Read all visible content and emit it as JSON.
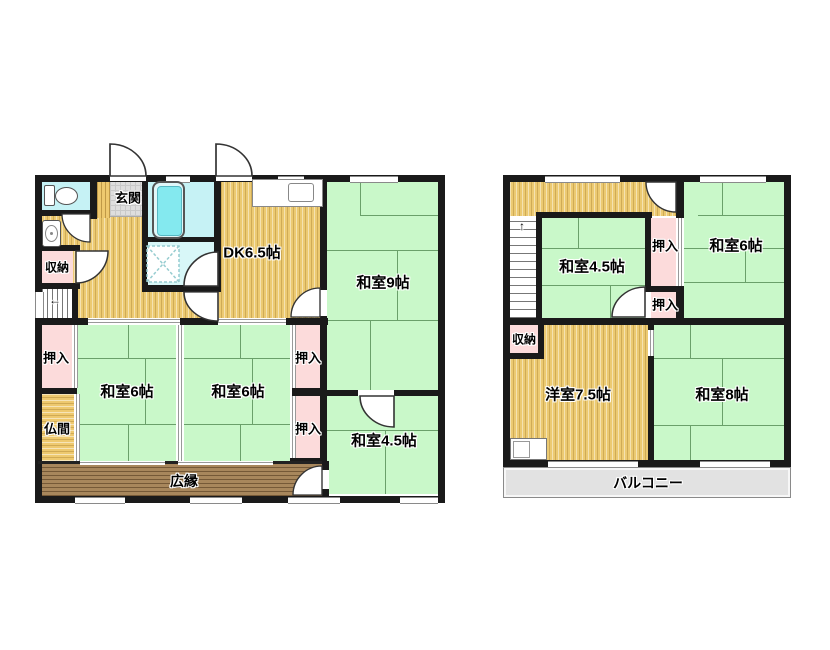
{
  "floor1": {
    "rooms": {
      "genkan": "玄関",
      "shuno": "収納",
      "dk": "DK6.5帖",
      "washitsu9": "和室9帖",
      "oshiire_left": "押入",
      "washitsu6_left": "和室6帖",
      "washitsu6_right": "和室6帖",
      "oshiire_mid_upper": "押入",
      "oshiire_mid_lower": "押入",
      "butsuma": "仏間",
      "washitsu45": "和室4.5帖",
      "hiroen": "広縁"
    },
    "stairs_arrow": "←"
  },
  "floor2": {
    "rooms": {
      "washitsu45": "和室4.5帖",
      "oshiire_upper": "押入",
      "washitsu6": "和室6帖",
      "oshiire_lower": "押入",
      "shuno": "収納",
      "yoshitsu": "洋室7.5帖",
      "washitsu8": "和室8帖",
      "balcony": "バルコニー"
    },
    "stairs_arrow": "↑"
  },
  "colors": {
    "wall": "#1a1a1a",
    "tatami_green": "#c9f8c9",
    "wood_tan": "#ecca72",
    "closet_pink": "#fcdbdb",
    "bath_cyan": "#c6f2f5",
    "entry_gray": "#dedede",
    "veranda_brown": "#a8875c",
    "balcony_gray": "#e2e2e2"
  }
}
